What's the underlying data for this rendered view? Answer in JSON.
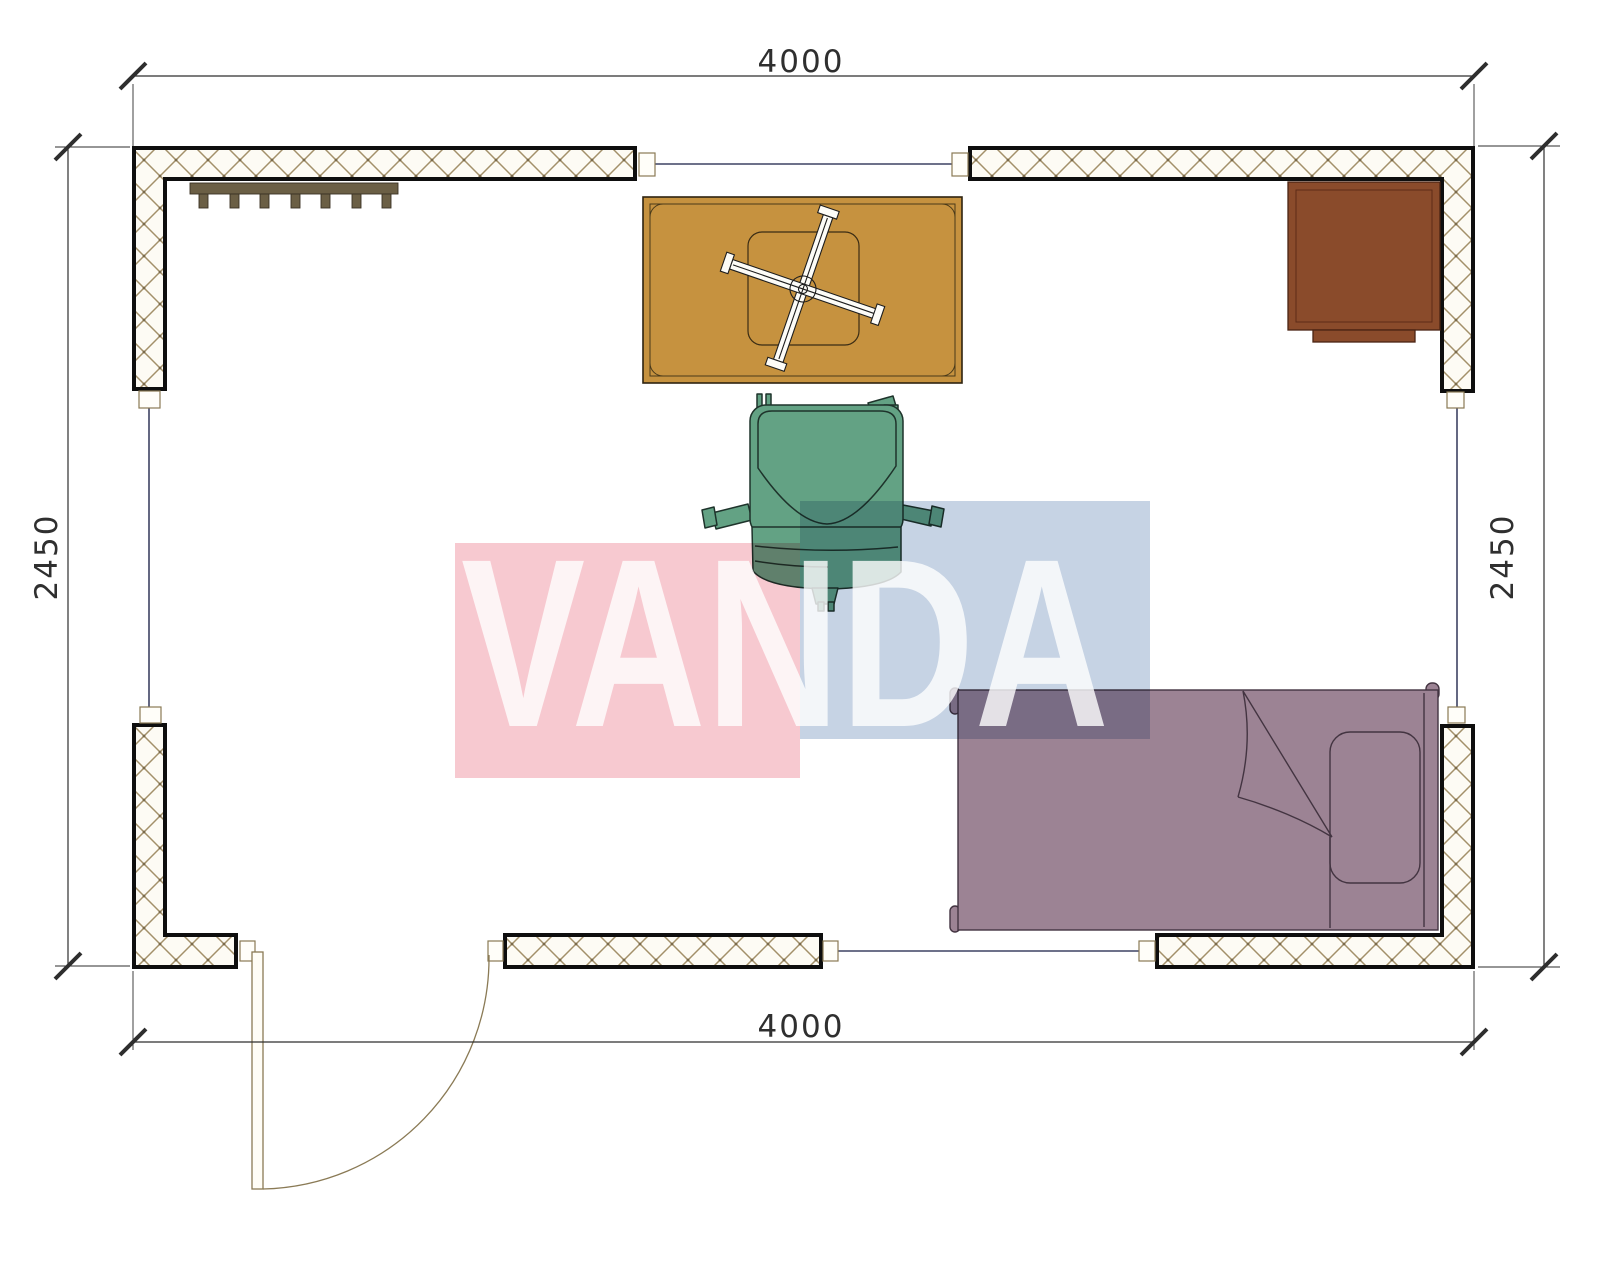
{
  "drawing": {
    "type": "floor-plan"
  },
  "dimensions": {
    "top": "4000",
    "bottom": "4000",
    "left": "2450",
    "right": "2450"
  },
  "watermark": {
    "text": "VANDA",
    "pink": "#f4b7c0",
    "blue": "#b3c4db"
  },
  "colors": {
    "wall_fill": "#0e0e0e",
    "hatch_line": "#a3906a",
    "coat_rack": "#6b5f45",
    "table": "#c6923f",
    "desk": "#8a4b2b",
    "chair": "#63a284",
    "bed": "#9c8394",
    "door": "#8a7a55",
    "window_line": "#3d4263",
    "dimension": "#2f2f2f"
  }
}
